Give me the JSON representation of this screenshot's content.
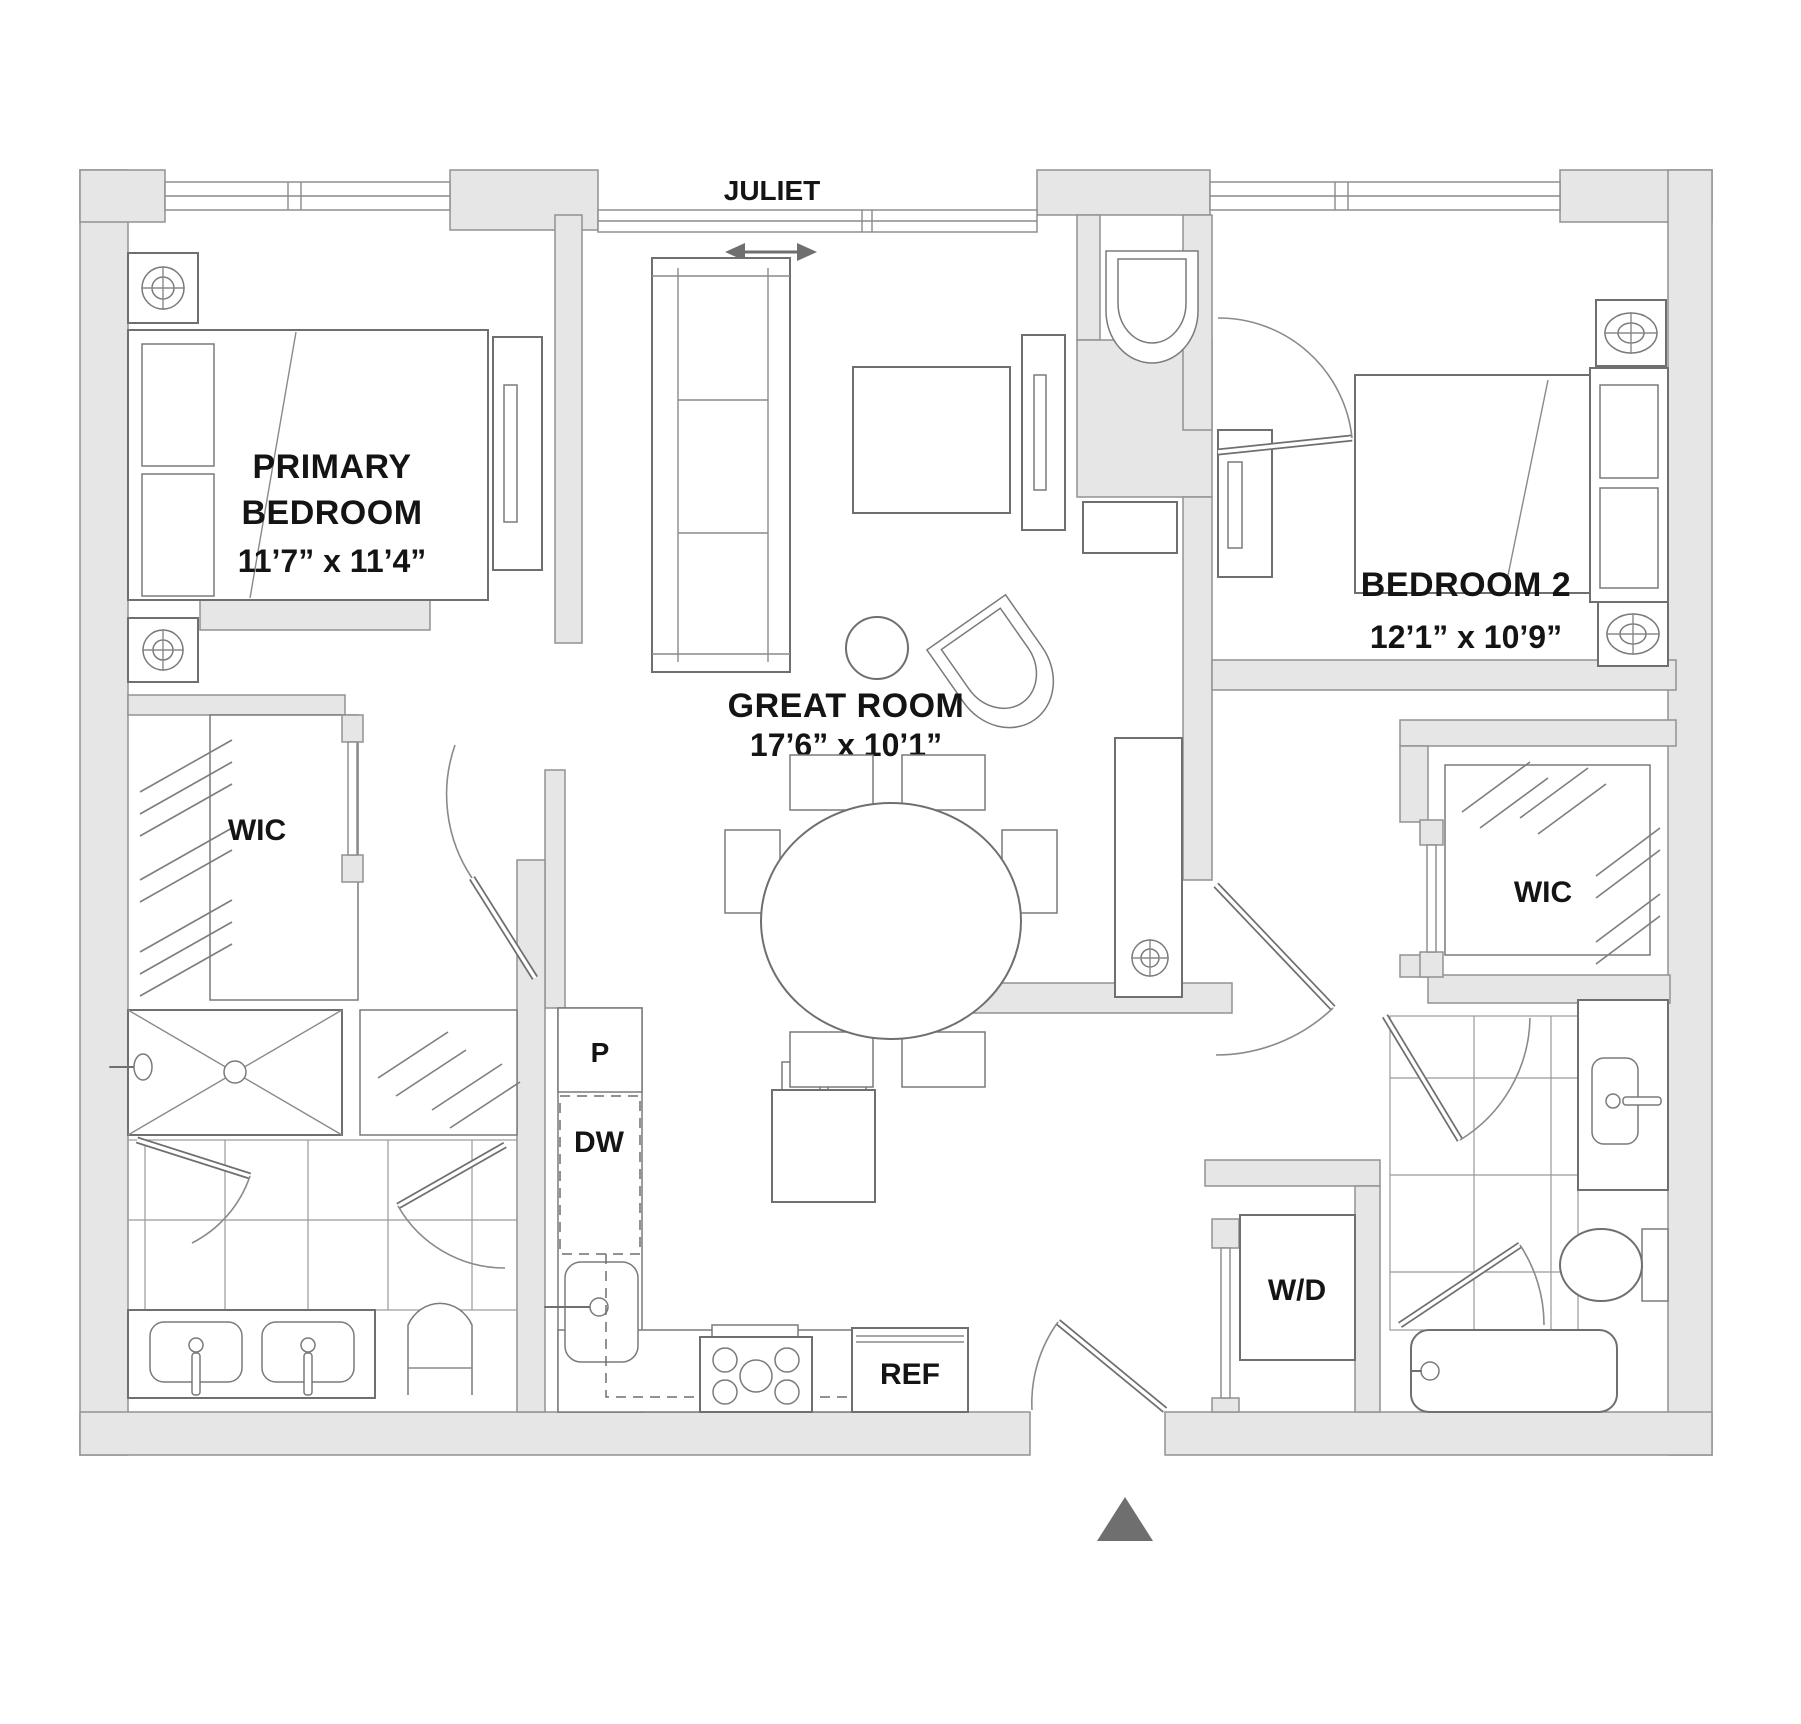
{
  "plan_title": "Two-bedroom apartment floor plan",
  "colors": {
    "wall_fill": "#e6e6e6",
    "wall_stroke": "#929292",
    "furniture_line": "#6f6f6f",
    "label_text": "#141414",
    "north_arrow": "#6f6f6f",
    "background": "#ffffff"
  },
  "rooms": {
    "primary_bedroom": {
      "line1": "PRIMARY",
      "line2": "BEDROOM",
      "dims": "11’7” x 11’4”"
    },
    "great_room": {
      "name": "GREAT ROOM",
      "dims": "17’6” x 10’1”"
    },
    "bedroom_2": {
      "name": "BEDROOM 2",
      "dims": "12’1” x 10’9”"
    },
    "wic_left": {
      "name": "WIC"
    },
    "wic_right": {
      "name": "WIC"
    },
    "juliet": {
      "name": "JULIET"
    }
  },
  "appliances": {
    "pantry": "P",
    "dishwasher": "DW",
    "refrigerator": "REF",
    "washer_dryer": "W/D"
  }
}
